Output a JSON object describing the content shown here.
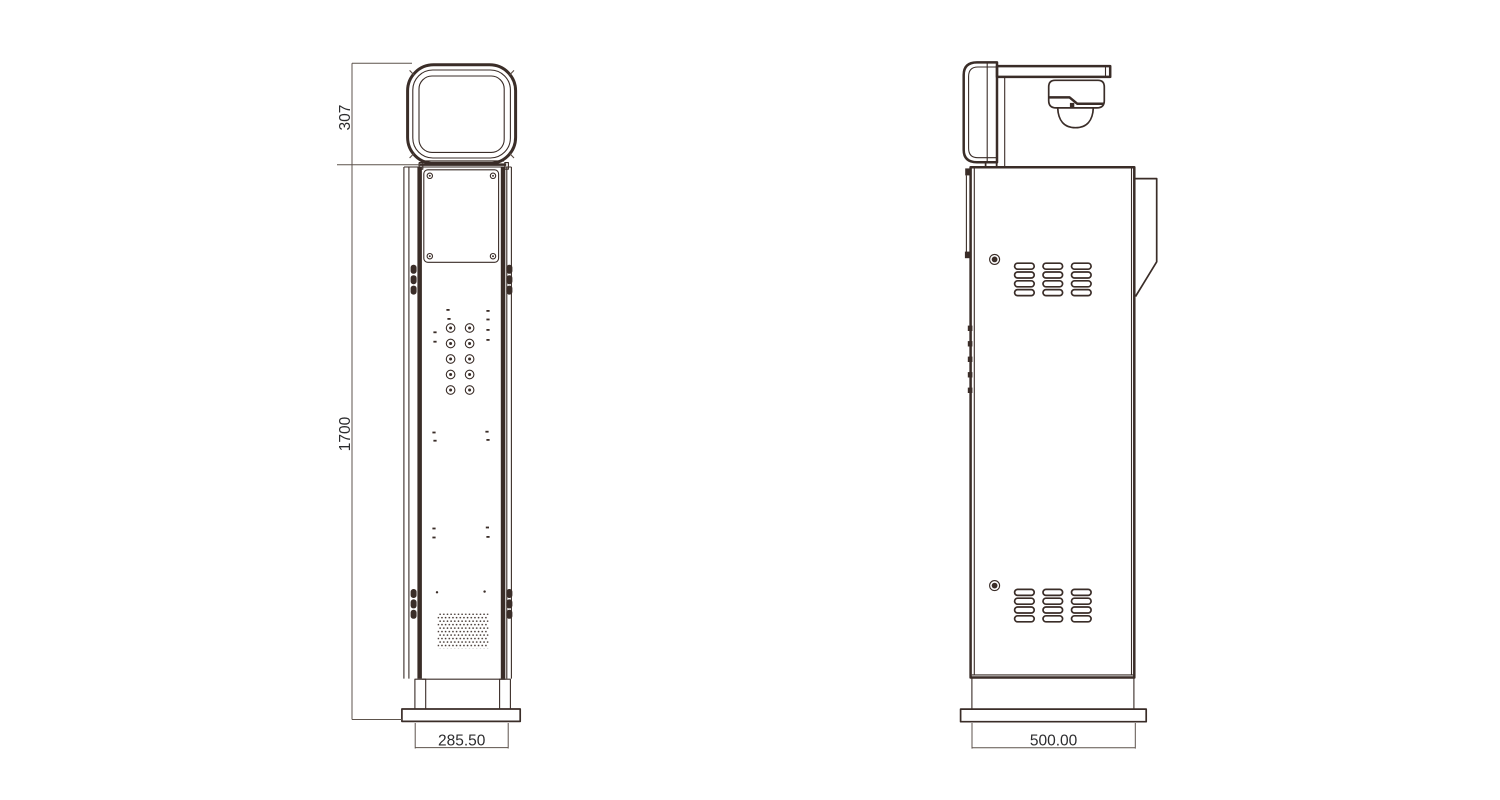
{
  "drawing": {
    "dimension_labels": {
      "head_height": "307",
      "overall_height": "1700",
      "front_width": "285.50",
      "side_depth": "500.00"
    },
    "colors": {
      "line": "#3a2d28",
      "line_soft": "#5a4c44",
      "dim_line": "#5d534c",
      "text": "#2c2c2e",
      "background": "#ffffff"
    }
  }
}
